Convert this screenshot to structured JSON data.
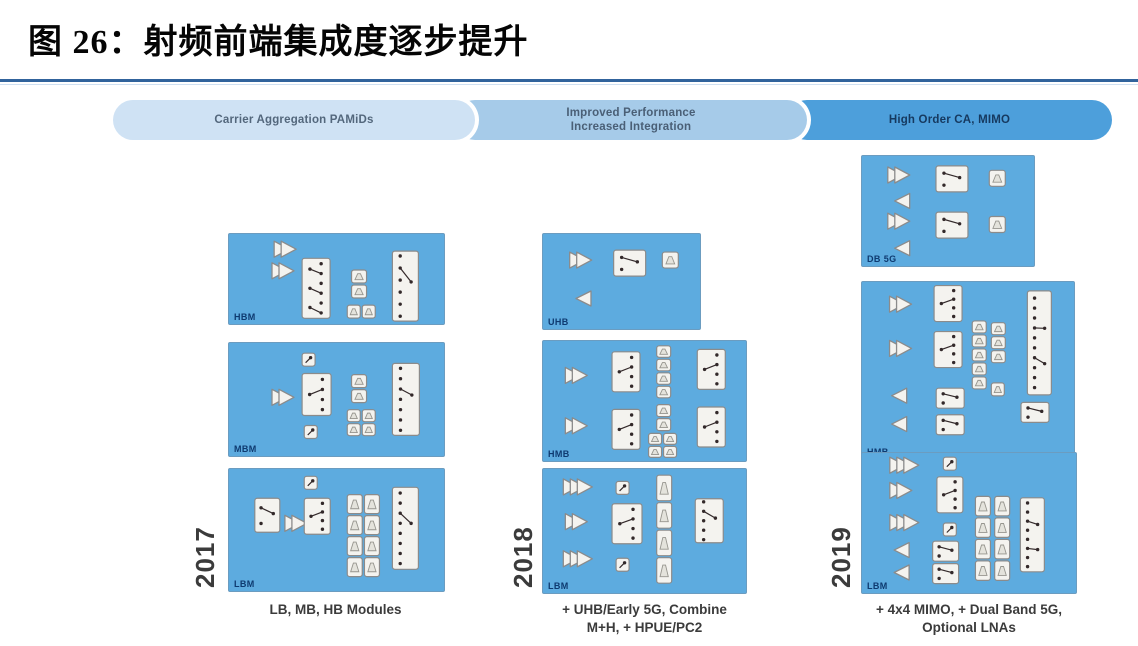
{
  "title": "图 26：射频前端集成度逐步提升",
  "palette": {
    "rule": "#31639c",
    "box_bg": "#5dabdf",
    "box_border": "#6b9cc0",
    "comp_bg": "#f4f3ef",
    "comp_border": "#8b8b8b",
    "dot": "#33292a",
    "label": "#0e3a70",
    "year": "#3b3b3b",
    "caption": "#3b3b3b"
  },
  "banners": [
    {
      "label": [
        "Carrier Aggregation PAMiDs"
      ],
      "bg": "#cfe2f4",
      "fg": "#53677c",
      "left": 113,
      "width": 362
    },
    {
      "label": [
        "Improved Performance",
        "Increased Integration"
      ],
      "bg": "#a6cbe9",
      "fg": "#4a5f76",
      "left": 455,
      "width": 352
    },
    {
      "label": [
        "High Order CA, MIMO"
      ],
      "bg": "#4d9fdb",
      "fg": "#16395f",
      "left": 787,
      "width": 325
    }
  ],
  "columns": [
    {
      "year": "2017",
      "caption": [
        "LB, MB, HB Modules"
      ],
      "caption_box": {
        "left": 218,
        "top": 601,
        "width": 235
      },
      "year_pos": {
        "left": 190,
        "top": 524,
        "height": 66
      },
      "boxes": [
        {
          "label": "HBM",
          "left": 228,
          "top": 233,
          "width": 215,
          "height": 90,
          "components": [
            {
              "t": "amp2",
              "x": 21,
              "y": 8
            },
            {
              "t": "amp2",
              "x": 20,
              "y": 32
            },
            {
              "t": "swm",
              "x": 34,
              "y": 27,
              "w": 28,
              "h": 60
            },
            {
              "t": "filt2v",
              "x": 57,
              "y": 40
            },
            {
              "t": "fpair",
              "x": 55,
              "y": 79
            },
            {
              "t": "swt",
              "x": 76,
              "y": 19,
              "w": 26,
              "h": 70,
              "n": 6
            }
          ]
        },
        {
          "label": "MBM",
          "left": 228,
          "top": 342,
          "width": 215,
          "height": 113,
          "components": [
            {
              "t": "boxs",
              "x": 34,
              "y": 9
            },
            {
              "t": "amp2",
              "x": 20,
              "y": 41
            },
            {
              "t": "sw",
              "x": 34,
              "y": 27,
              "w": 29,
              "h": 42,
              "n": 4
            },
            {
              "t": "boxs",
              "x": 35,
              "y": 73
            },
            {
              "t": "filt2v",
              "x": 57,
              "y": 28
            },
            {
              "t": "fgrid",
              "x": 55,
              "y": 59
            },
            {
              "t": "swt",
              "x": 76,
              "y": 18,
              "w": 27,
              "h": 72,
              "n": 7
            }
          ]
        },
        {
          "label": "LBM",
          "left": 228,
          "top": 468,
          "width": 215,
          "height": 122,
          "components": [
            {
              "t": "boxs",
              "x": 35,
              "y": 6
            },
            {
              "t": "swh",
              "x": 12,
              "y": 24,
              "w": 25,
              "h": 34
            },
            {
              "t": "amp2",
              "x": 26,
              "y": 38
            },
            {
              "t": "sw",
              "x": 35,
              "y": 24,
              "w": 26,
              "h": 36,
              "n": 4
            },
            {
              "t": "fcol",
              "x": 55,
              "y": 21,
              "w": 15,
              "h": 82,
              "n": 4
            },
            {
              "t": "fcol",
              "x": 63,
              "y": 21,
              "w": 15,
              "h": 82,
              "n": 4
            },
            {
              "t": "swt",
              "x": 76,
              "y": 15,
              "w": 26,
              "h": 82,
              "n": 8
            }
          ]
        }
      ]
    },
    {
      "year": "2018",
      "caption": [
        "+ UHB/Early 5G, Combine",
        "M+H, + HPUE/PC2"
      ],
      "caption_box": {
        "left": 527,
        "top": 601,
        "width": 235
      },
      "year_pos": {
        "left": 508,
        "top": 522,
        "height": 70
      },
      "boxes": [
        {
          "label": "UHB",
          "left": 542,
          "top": 233,
          "width": 157,
          "height": 95,
          "components": [
            {
              "t": "amp2",
              "x": 17,
              "y": 19
            },
            {
              "t": "swh",
              "x": 45,
              "y": 17,
              "w": 32,
              "h": 26
            },
            {
              "t": "filt1",
              "x": 76,
              "y": 19
            },
            {
              "t": "lna",
              "x": 21,
              "y": 60
            }
          ]
        },
        {
          "label": "HMB",
          "left": 542,
          "top": 340,
          "width": 203,
          "height": 120,
          "components": [
            {
              "t": "amp2",
              "x": 11,
              "y": 22
            },
            {
              "t": "amp2",
              "x": 11,
              "y": 64
            },
            {
              "t": "sw",
              "x": 34,
              "y": 9,
              "w": 28,
              "h": 40,
              "n": 4
            },
            {
              "t": "sw",
              "x": 34,
              "y": 57,
              "w": 28,
              "h": 40,
              "n": 4
            },
            {
              "t": "fcol",
              "x": 56,
              "y": 4,
              "w": 14,
              "h": 52,
              "n": 4
            },
            {
              "t": "fcol",
              "x": 56,
              "y": 53,
              "w": 14,
              "h": 26,
              "n": 2
            },
            {
              "t": "fgrid",
              "x": 52,
              "y": 77,
              "w": 28,
              "h": 24
            },
            {
              "t": "sw",
              "x": 76,
              "y": 7,
              "w": 28,
              "h": 40,
              "n": 4
            },
            {
              "t": "sw",
              "x": 76,
              "y": 55,
              "w": 28,
              "h": 40,
              "n": 4
            }
          ]
        },
        {
          "label": "LBM",
          "left": 542,
          "top": 468,
          "width": 203,
          "height": 124,
          "components": [
            {
              "t": "amp3",
              "x": 10,
              "y": 8
            },
            {
              "t": "amp2",
              "x": 11,
              "y": 36
            },
            {
              "t": "amp3",
              "x": 10,
              "y": 66
            },
            {
              "t": "boxs",
              "x": 36,
              "y": 10
            },
            {
              "t": "sw",
              "x": 34,
              "y": 28,
              "w": 30,
              "h": 40,
              "n": 4
            },
            {
              "t": "boxs",
              "x": 36,
              "y": 72
            },
            {
              "t": "fcol",
              "x": 56,
              "y": 5,
              "w": 15,
              "h": 108,
              "n": 4
            },
            {
              "t": "swt",
              "x": 75,
              "y": 24,
              "w": 28,
              "h": 44,
              "n": 5,
              "p": 1
            }
          ]
        }
      ]
    },
    {
      "year": "2019",
      "caption": [
        "+ 4x4 MIMO, + Dual Band 5G,",
        "Optional LNAs"
      ],
      "caption_box": {
        "left": 843,
        "top": 601,
        "width": 252
      },
      "year_pos": {
        "left": 826,
        "top": 522,
        "height": 70
      },
      "boxes": [
        {
          "label": "DB 5G",
          "left": 861,
          "top": 155,
          "width": 172,
          "height": 110,
          "components": [
            {
              "t": "amp2",
              "x": 15,
              "y": 10
            },
            {
              "t": "swh",
              "x": 43,
              "y": 9,
              "w": 32,
              "h": 26
            },
            {
              "t": "filt1",
              "x": 74,
              "y": 13
            },
            {
              "t": "lna",
              "x": 19,
              "y": 34
            },
            {
              "t": "amp2",
              "x": 15,
              "y": 52
            },
            {
              "t": "swh",
              "x": 43,
              "y": 51,
              "w": 32,
              "h": 26
            },
            {
              "t": "filt1",
              "x": 74,
              "y": 55
            },
            {
              "t": "lna",
              "x": 19,
              "y": 77
            }
          ]
        },
        {
          "label": "HMB",
          "left": 861,
          "top": 281,
          "width": 212,
          "height": 177,
          "components": [
            {
              "t": "amp2",
              "x": 13,
              "y": 8
            },
            {
              "t": "amp2",
              "x": 13,
              "y": 33
            },
            {
              "t": "sw",
              "x": 34,
              "y": 2,
              "w": 28,
              "h": 36,
              "n": 4
            },
            {
              "t": "sw",
              "x": 34,
              "y": 28,
              "w": 28,
              "h": 36,
              "n": 4
            },
            {
              "t": "fcol",
              "x": 52,
              "y": 22,
              "w": 14,
              "h": 68,
              "n": 5
            },
            {
              "t": "fcol",
              "x": 61,
              "y": 23,
              "w": 14,
              "h": 40,
              "n": 3
            },
            {
              "t": "filt1",
              "x": 61,
              "y": 57,
              "w": 13,
              "h": 13
            },
            {
              "t": "swt",
              "x": 78,
              "y": 5,
              "w": 24,
              "h": 104,
              "n": 10,
              "p": 2
            },
            {
              "t": "lna",
              "x": 14,
              "y": 60
            },
            {
              "t": "lna",
              "x": 14,
              "y": 76
            },
            {
              "t": "swh",
              "x": 35,
              "y": 60,
              "w": 28,
              "h": 20
            },
            {
              "t": "swh",
              "x": 35,
              "y": 75,
              "w": 28,
              "h": 20
            },
            {
              "t": "swh",
              "x": 75,
              "y": 68,
              "w": 28,
              "h": 20
            }
          ]
        },
        {
          "label": "LBM",
          "left": 861,
          "top": 452,
          "width": 214,
          "height": 140,
          "components": [
            {
              "t": "amp3",
              "x": 13,
              "y": 3
            },
            {
              "t": "amp2",
              "x": 13,
              "y": 21
            },
            {
              "t": "amp3",
              "x": 13,
              "y": 44
            },
            {
              "t": "lna",
              "x": 15,
              "y": 64
            },
            {
              "t": "lna",
              "x": 15,
              "y": 80
            },
            {
              "t": "boxs",
              "x": 38,
              "y": 3
            },
            {
              "t": "sw",
              "x": 35,
              "y": 17,
              "w": 26,
              "h": 36,
              "n": 4
            },
            {
              "t": "boxs",
              "x": 38,
              "y": 50
            },
            {
              "t": "swh",
              "x": 33,
              "y": 63,
              "w": 26,
              "h": 20
            },
            {
              "t": "swh",
              "x": 33,
              "y": 79,
              "w": 26,
              "h": 20
            },
            {
              "t": "fcol",
              "x": 53,
              "y": 31,
              "w": 15,
              "h": 84,
              "n": 4
            },
            {
              "t": "fcol",
              "x": 62,
              "y": 31,
              "w": 15,
              "h": 84,
              "n": 4
            },
            {
              "t": "swt",
              "x": 74,
              "y": 32,
              "w": 24,
              "h": 74,
              "n": 8,
              "p": 2
            }
          ]
        }
      ]
    }
  ]
}
